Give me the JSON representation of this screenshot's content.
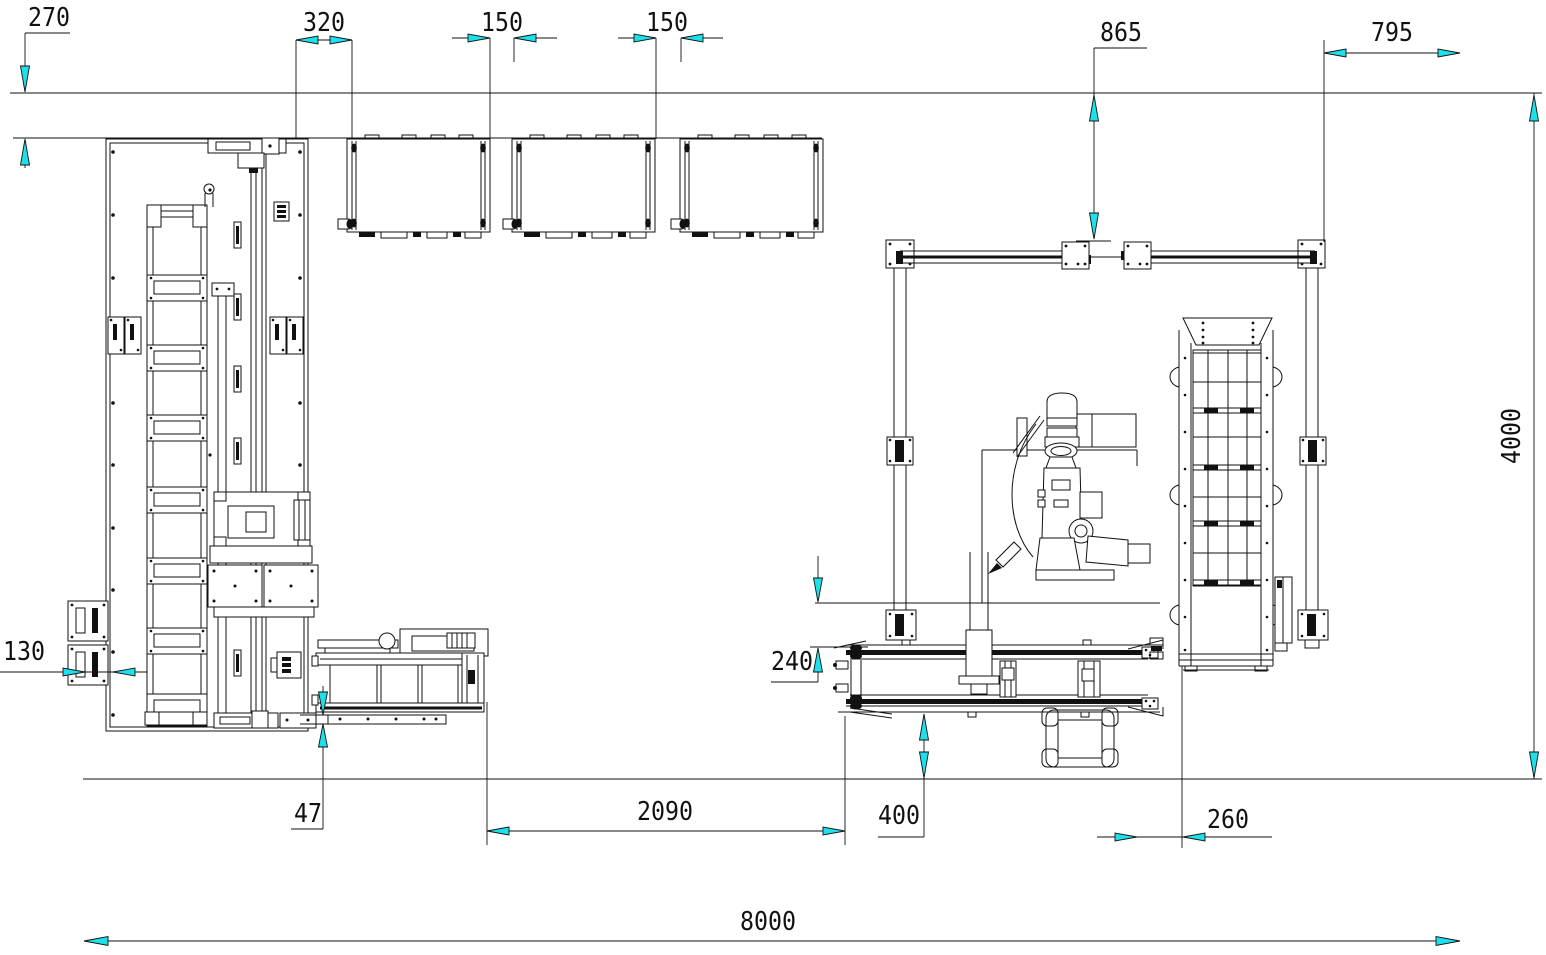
{
  "drawing": {
    "units": "mm",
    "colors": {
      "background": "#ffffff",
      "line": "#111111",
      "arrow_fill": "#1ee0ea"
    },
    "dimensions": {
      "d270": "270",
      "d320": "320",
      "d150a": "150",
      "d150b": "150",
      "d865": "865",
      "d795": "795",
      "d4000": "4000",
      "d130": "130",
      "d47": "47",
      "d2090": "2090",
      "d240": "240",
      "d400": "400",
      "d260": "260",
      "d8000": "8000"
    }
  }
}
